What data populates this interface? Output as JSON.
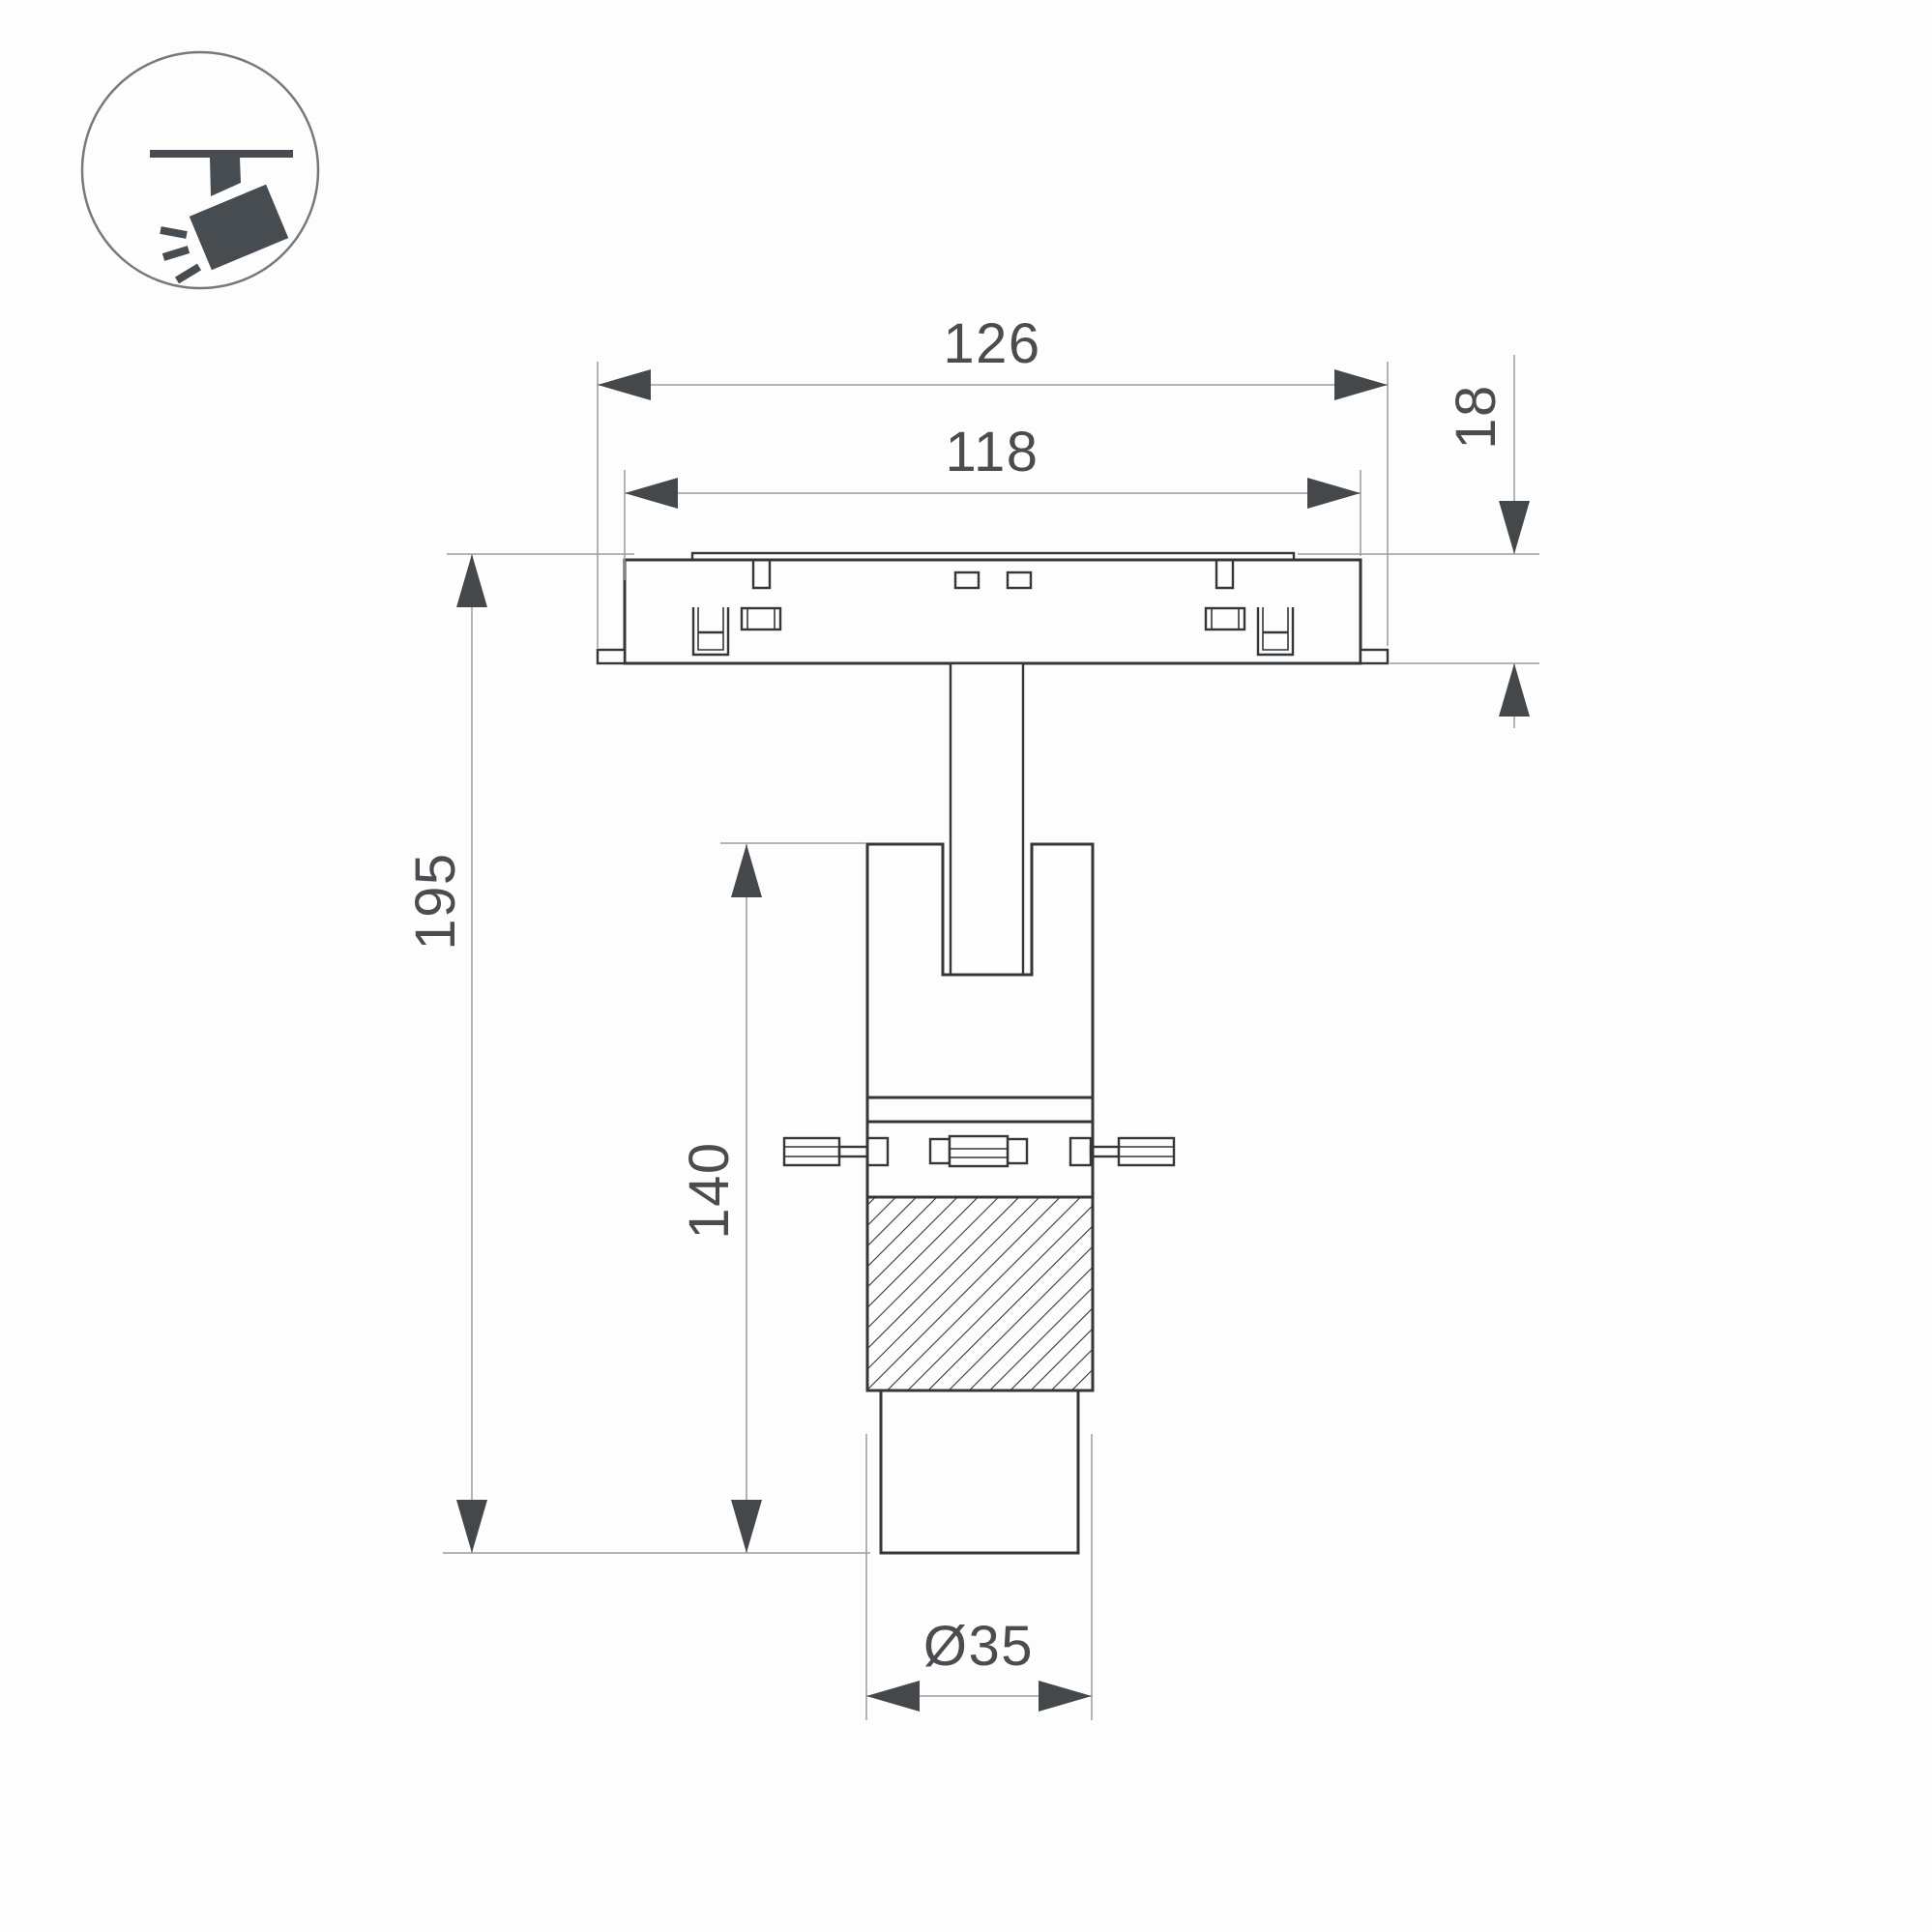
{
  "icon_badge": {
    "name": "track-spotlight",
    "color": "#474c51",
    "circle_color": "#76797c"
  },
  "drawing": {
    "labels": {
      "width_overall": "126",
      "width_inner": "118",
      "base_height": "18",
      "height_total": "195",
      "height_body": "140",
      "diameter": "Ø35"
    },
    "colors": {
      "outline": "#33373a",
      "dimension_line": "#9b9c9e",
      "arrow": "#45484b",
      "text": "#4a4d50",
      "background": "#fdfdfe"
    }
  }
}
